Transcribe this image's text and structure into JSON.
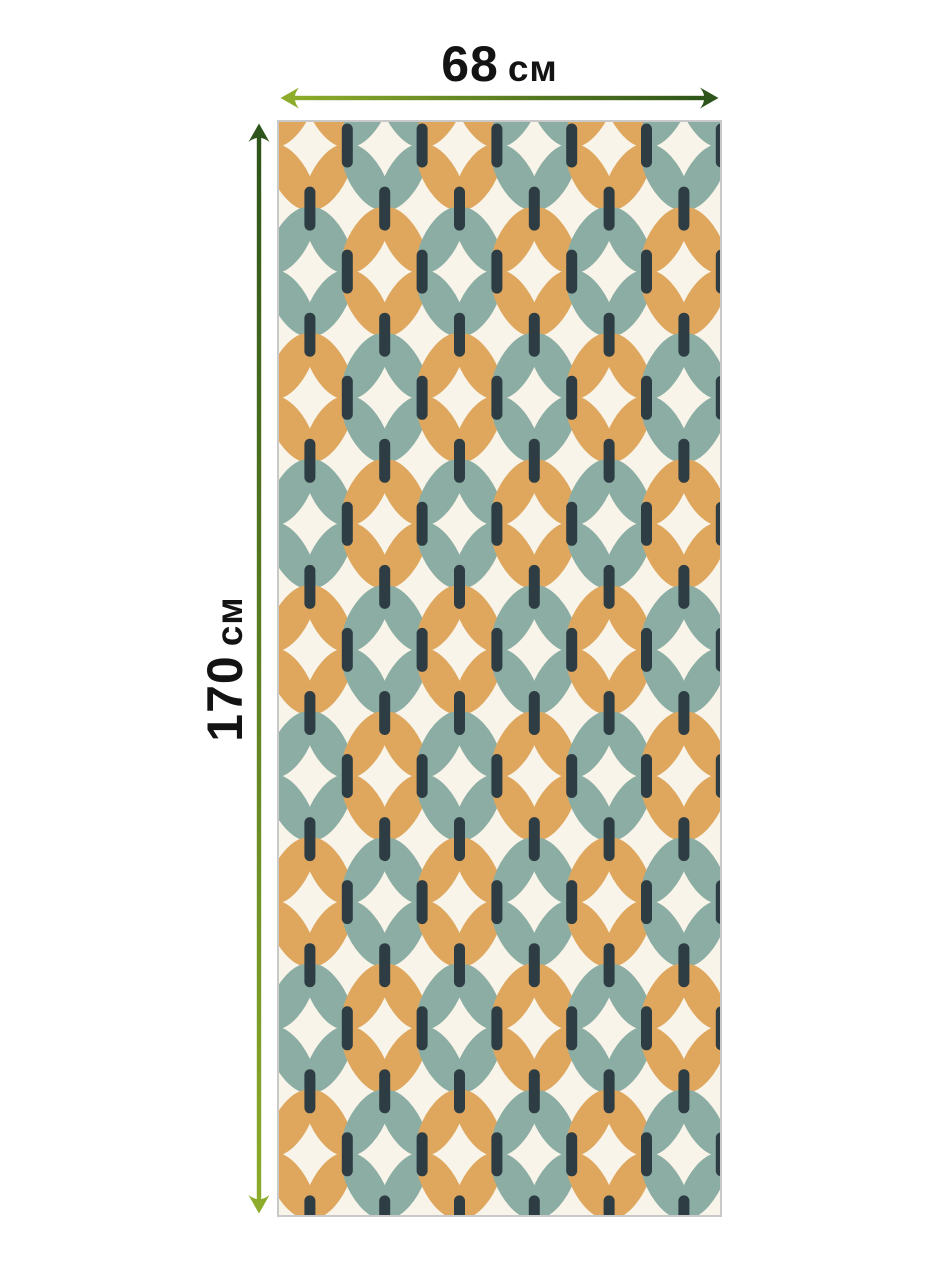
{
  "dimensions": {
    "width": {
      "value": "68",
      "unit": "см"
    },
    "height": {
      "value": "170",
      "unit": "см"
    }
  },
  "arrows": {
    "light_green": "#8dac2b",
    "dark_green": "#2d541a"
  },
  "panel": {
    "background": "#f8f4e9",
    "border_color": "#c9c9c9"
  },
  "pattern": {
    "petal_teal": "#8bada3",
    "petal_orange": "#dfa75e",
    "capsule_color": "#2e3d44",
    "cols": 13,
    "rows": 19,
    "col_step": 37.4,
    "row_step": 63.05,
    "origin_x": -6.5,
    "origin_y": -39.5,
    "petal_rx": 17,
    "petal_ry": 36.7,
    "capsule_w": 11,
    "capsule_h": 44
  }
}
